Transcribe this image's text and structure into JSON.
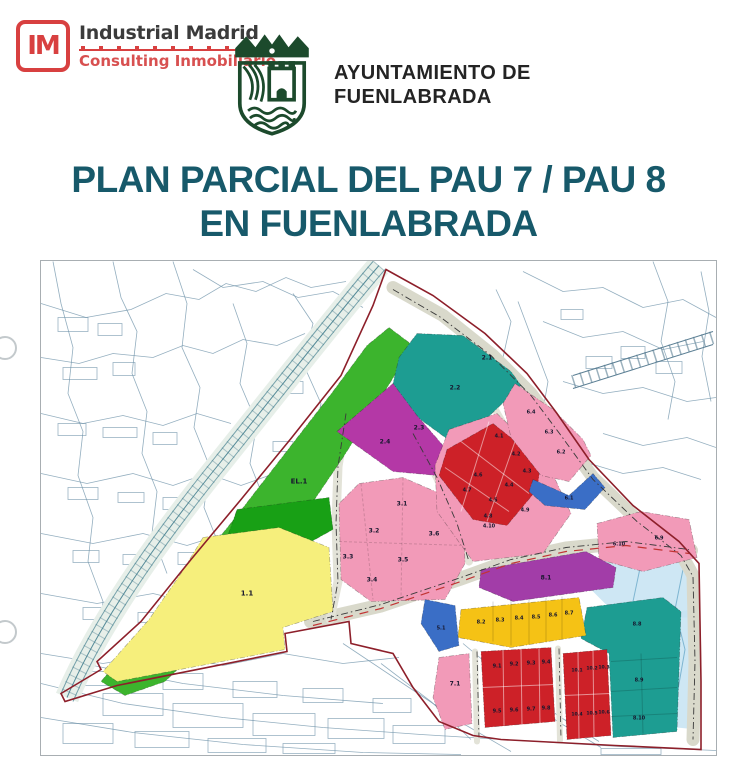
{
  "header": {
    "logo": {
      "monogram": "IM",
      "company": "Industrial Madrid",
      "tagline": "Consulting Inmobiliario"
    },
    "ayuntamiento": {
      "line1": "AYUNTAMIENTO DE",
      "line2": "FUENLABRADA"
    }
  },
  "title": {
    "line1": "PLAN PARCIAL DEL PAU 7 / PAU 8",
    "line2": "EN FUENLABRADA"
  },
  "colors": {
    "accent_red": "#d84040",
    "title_teal": "#17596a",
    "crest_green": "#1c4a2c",
    "boundary_red": "#8d1f2a"
  },
  "map": {
    "boundary_color": "#8d1f2a",
    "parcels": [
      {
        "id": "el-1",
        "color": "#3cb42d",
        "points": "348,66 372,84 340,136 302,196 260,258 216,318 170,376 124,420 84,434 60,420 100,372 148,314 196,254 244,192 292,130 326,84",
        "labels": [
          {
            "text": "EL.1",
            "x": 258,
            "y": 222,
            "s": 7
          }
        ]
      },
      {
        "id": "verde-oscuro",
        "color": "#18a015",
        "points": "196,248 288,236 292,268 238,298 182,288",
        "labels": []
      },
      {
        "id": "1-1",
        "color": "#f6ef7c",
        "points": "162,276 238,266 288,286 292,350 242,366 244,388 76,420 62,410 108,358 140,312",
        "labels": [
          {
            "text": "1.1",
            "x": 206,
            "y": 334,
            "s": 7
          }
        ]
      },
      {
        "id": "2-teal",
        "color": "#1d9d92",
        "points": "376,72 422,74 470,110 480,124 430,172 418,186 374,154 352,122 358,96",
        "labels": [
          {
            "text": "2.1",
            "x": 446,
            "y": 98,
            "s": 6
          },
          {
            "text": "2.2",
            "x": 414,
            "y": 128,
            "s": 6
          }
        ]
      },
      {
        "id": "2-magenta",
        "color": "#b438a6",
        "points": "296,170 352,122 376,154 402,184 396,214 352,210",
        "labels": [
          {
            "text": "2.3",
            "x": 378,
            "y": 168,
            "s": 6
          },
          {
            "text": "2.4",
            "x": 344,
            "y": 182,
            "s": 6
          }
        ]
      },
      {
        "id": "3",
        "color": "#f29ab8",
        "points": "318,222 362,216 422,242 424,302 404,338 330,340 300,318 298,242",
        "labels": [
          {
            "text": "3.1",
            "x": 361,
            "y": 244,
            "s": 6
          },
          {
            "text": "3.2",
            "x": 333,
            "y": 271,
            "s": 6
          },
          {
            "text": "3.3",
            "x": 307,
            "y": 297,
            "s": 6
          },
          {
            "text": "3.4",
            "x": 331,
            "y": 320,
            "s": 6
          },
          {
            "text": "3.5",
            "x": 362,
            "y": 300,
            "s": 6
          },
          {
            "text": "3.6",
            "x": 393,
            "y": 274,
            "s": 6
          }
        ]
      },
      {
        "id": "4-pink",
        "color": "#f29ab8",
        "points": "408,168 456,152 506,200 530,252 502,292 432,300 396,250 394,204",
        "labels": [
          {
            "text": "4.9",
            "x": 484,
            "y": 250,
            "s": 5
          },
          {
            "text": "4.10",
            "x": 448,
            "y": 266,
            "s": 5
          }
        ]
      },
      {
        "id": "4-red",
        "color": "#cd2128",
        "points": "452,162 500,200 496,228 466,264 432,258 398,214 406,188",
        "labels": [
          {
            "text": "4.1",
            "x": 458,
            "y": 176,
            "s": 5
          },
          {
            "text": "4.2",
            "x": 475,
            "y": 194,
            "s": 5
          },
          {
            "text": "4.3",
            "x": 486,
            "y": 211,
            "s": 5
          },
          {
            "text": "4.4",
            "x": 468,
            "y": 225,
            "s": 5
          },
          {
            "text": "4.5",
            "x": 452,
            "y": 240,
            "s": 5
          },
          {
            "text": "4.6",
            "x": 437,
            "y": 215,
            "s": 5
          },
          {
            "text": "4.7",
            "x": 426,
            "y": 230,
            "s": 5
          },
          {
            "text": "4.8",
            "x": 447,
            "y": 256,
            "s": 5
          }
        ]
      },
      {
        "id": "6-pink",
        "color": "#f29ab8",
        "points": "474,122 512,148 542,178 550,194 528,220 500,214 470,176 462,142",
        "labels": [
          {
            "text": "6.4",
            "x": 490,
            "y": 152,
            "s": 5
          },
          {
            "text": "6.3",
            "x": 508,
            "y": 172,
            "s": 5
          },
          {
            "text": "6.2",
            "x": 520,
            "y": 192,
            "s": 5
          }
        ]
      },
      {
        "id": "6-1",
        "color": "#3a6ec6",
        "points": "492,218 528,234 552,212 564,226 544,248 504,244 488,230",
        "labels": [
          {
            "text": "6.1",
            "x": 528,
            "y": 238,
            "s": 5
          }
        ]
      },
      {
        "id": "6-910",
        "color": "#f29ab8",
        "points": "556,262 600,250 648,258 656,296 602,310 558,298",
        "labels": [
          {
            "text": "6.10",
            "x": 578,
            "y": 284,
            "s": 5
          },
          {
            "text": "6.9",
            "x": 618,
            "y": 278,
            "s": 5
          }
        ]
      },
      {
        "id": "8-1",
        "color": "#a23da8",
        "points": "440,308 545,290 575,306 572,326 472,340 438,326",
        "labels": [
          {
            "text": "8.1",
            "x": 505,
            "y": 318,
            "s": 6
          }
        ]
      },
      {
        "id": "8-teal",
        "color": "#1d9d92",
        "points": "546,346 622,336 640,350 636,470 572,476 568,392 540,377",
        "labels": [
          {
            "text": "8.8",
            "x": 596,
            "y": 364,
            "s": 5
          },
          {
            "text": "8.9",
            "x": 598,
            "y": 420,
            "s": 5
          },
          {
            "text": "8.10",
            "x": 598,
            "y": 458,
            "s": 5
          }
        ]
      },
      {
        "id": "8-strip",
        "color": "#f5c215",
        "points": "420,348 538,336 545,374 470,386 417,376",
        "labels": [
          {
            "text": "8.2",
            "x": 440,
            "y": 362,
            "s": 5
          },
          {
            "text": "8.3",
            "x": 459,
            "y": 360,
            "s": 5
          },
          {
            "text": "8.4",
            "x": 478,
            "y": 358,
            "s": 5
          },
          {
            "text": "8.5",
            "x": 495,
            "y": 357,
            "s": 5
          },
          {
            "text": "8.6",
            "x": 512,
            "y": 355,
            "s": 5
          },
          {
            "text": "8.7",
            "x": 528,
            "y": 353,
            "s": 5
          }
        ]
      },
      {
        "id": "5-1",
        "color": "#3a6ec6",
        "points": "384,338 414,344 418,384 398,390 380,362",
        "labels": [
          {
            "text": "5.1",
            "x": 400,
            "y": 368,
            "s": 5
          }
        ]
      },
      {
        "id": "7-1",
        "color": "#f29ab8",
        "points": "398,396 428,392 431,462 404,468 392,436",
        "labels": [
          {
            "text": "7.1",
            "x": 414,
            "y": 424,
            "s": 6
          }
        ]
      },
      {
        "id": "9",
        "color": "#cd2128",
        "points": "440,390 510,386 514,460 444,466",
        "labels": [
          {
            "text": "9.1",
            "x": 456,
            "y": 406,
            "s": 5
          },
          {
            "text": "9.2",
            "x": 473,
            "y": 404,
            "s": 5
          },
          {
            "text": "9.3",
            "x": 490,
            "y": 403,
            "s": 5
          },
          {
            "text": "9.4",
            "x": 505,
            "y": 402,
            "s": 5
          },
          {
            "text": "9.5",
            "x": 456,
            "y": 451,
            "s": 5
          },
          {
            "text": "9.6",
            "x": 473,
            "y": 450,
            "s": 5
          },
          {
            "text": "9.7",
            "x": 490,
            "y": 449,
            "s": 5
          },
          {
            "text": "9.8",
            "x": 505,
            "y": 448,
            "s": 5
          }
        ]
      },
      {
        "id": "10",
        "color": "#cd2128",
        "points": "522,392 566,388 570,474 526,478",
        "labels": [
          {
            "text": "10.1",
            "x": 536,
            "y": 410,
            "s": 4.6
          },
          {
            "text": "10.2",
            "x": 551,
            "y": 408,
            "s": 4.6
          },
          {
            "text": "10.3",
            "x": 563,
            "y": 407,
            "s": 4.6
          },
          {
            "text": "10.4",
            "x": 536,
            "y": 454,
            "s": 4.6
          },
          {
            "text": "10.5",
            "x": 551,
            "y": 453,
            "s": 4.6
          },
          {
            "text": "10.6",
            "x": 563,
            "y": 452,
            "s": 4.6
          }
        ]
      }
    ]
  }
}
